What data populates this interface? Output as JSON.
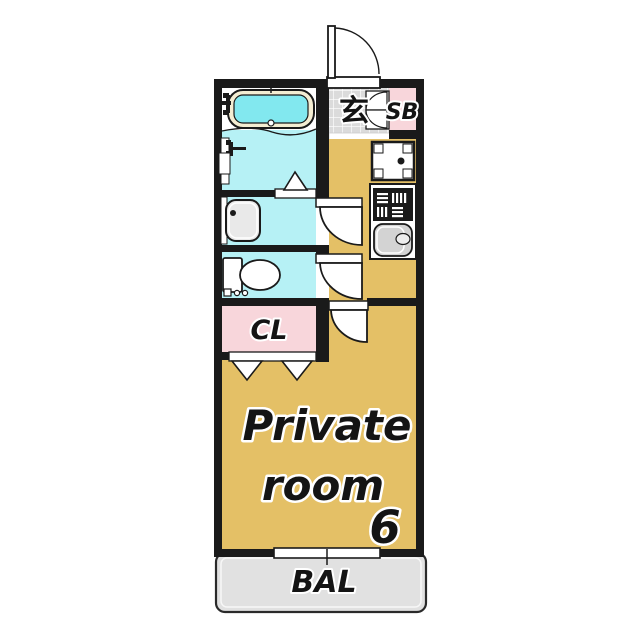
{
  "labels": {
    "entrance": "玄",
    "shoe_box": "SB",
    "closet": "CL",
    "room_name_line1": "Private",
    "room_name_line2": "room",
    "room_size": "6",
    "balcony": "BAL"
  },
  "colors": {
    "wall": "#1a1a1a",
    "room_floor": "#E4C066",
    "wet_area": "#B6F1F5",
    "bath_water": "#82E8EF",
    "tub_rim": "#F4EDD2",
    "closet_pink": "#F8D6DB",
    "entrance_tile": "#DBDBDB",
    "balcony_gray": "#E1E1E1",
    "sink_gray": "#D3D3D3",
    "fixture_gray": "#E9E9E9"
  },
  "icons": [
    "entrance-door-icon",
    "shoe-box-door-icon",
    "bathtub-icon",
    "bath-faucet-icon",
    "shower-faucet-icon",
    "washbasin-icon",
    "toilet-icon",
    "washing-machine-pan-icon",
    "stove-icon",
    "kitchen-sink-icon",
    "folding-door-icon",
    "swing-door-icon",
    "window-icon"
  ]
}
